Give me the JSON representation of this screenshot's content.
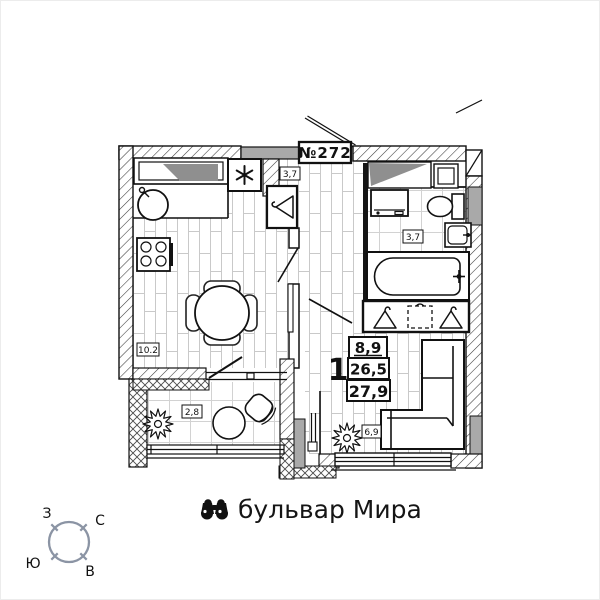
{
  "plan": {
    "apartment_number": "№272",
    "stamp": {
      "rooms": "1",
      "living_area": "8,9",
      "area": "26,5",
      "total_area": "27,9"
    },
    "rooms": {
      "kitchen": {
        "area": "10.2"
      },
      "hall": {
        "area": "3,7"
      },
      "bathroom": {
        "area": "3,7"
      },
      "balcony": {
        "area": "2,8"
      },
      "room": {
        "area": "6,9"
      }
    }
  },
  "street": {
    "name": "бульвар Мира"
  },
  "compass": {
    "west": "З",
    "north": "С",
    "south": "Ю",
    "east": "В",
    "color": "#8b94a4"
  },
  "colors": {
    "line": "#111111",
    "wall_gray": "#a9a9a9",
    "shadow_gray": "#8f8f8f",
    "floor_line": "#c9c9c9"
  },
  "icons": {
    "street": "binoculars-icon",
    "vent": "asterisk-vent-icon",
    "closet": "hanger-icon",
    "decor": "plant-icon"
  }
}
